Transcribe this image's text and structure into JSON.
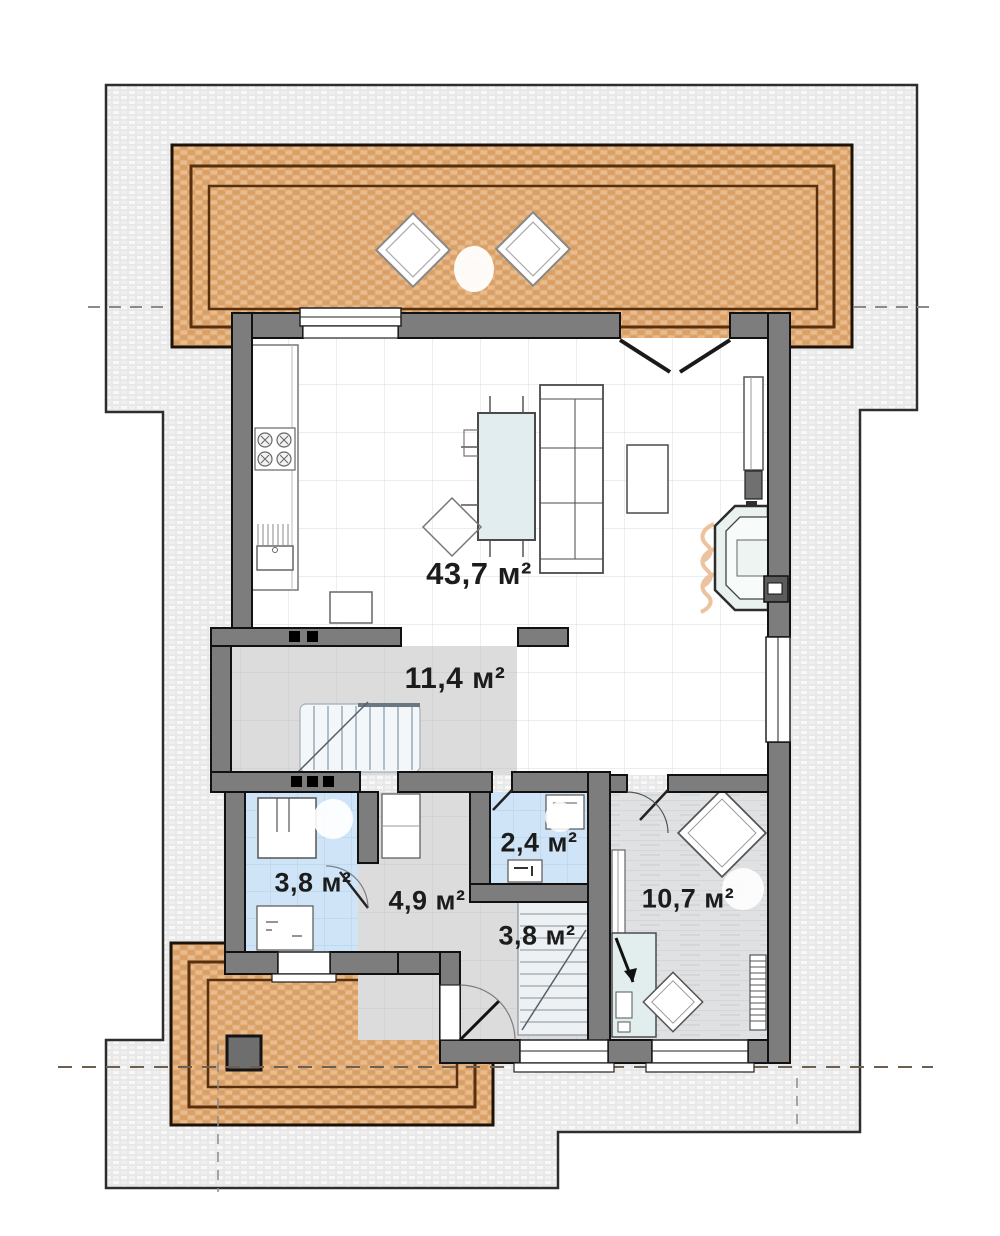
{
  "rooms": {
    "living": {
      "label": "43,7 м²"
    },
    "hall": {
      "label": "11,4 м²"
    },
    "bathroom": {
      "label": "3,8 м²"
    },
    "corridor": {
      "label": "4,9 м²"
    },
    "wc": {
      "label": "2,4 м²"
    },
    "staircase": {
      "label": "3,8 м²"
    },
    "bedroom": {
      "label": "10,7 м²"
    }
  },
  "colors": {
    "paving_fill": "#e9e9e9",
    "paving_border": "#2e2e2e",
    "terrace_fill": "#dfa873",
    "terrace_border_dark": "#1d1208",
    "terrace_border_brown": "#59300e",
    "wall_fill": "#7d7d7d",
    "wall_outline": "#111111",
    "living_floor": "#ffffff",
    "hall_floor": "#dcdcdc",
    "wet_room_floor": "#cfe5f7",
    "bedroom_floor": "#dfe1e3",
    "furniture_outline": "#4a4a4a",
    "flame_accent": "#e9b98e",
    "label_text": "#1c1c1c"
  }
}
